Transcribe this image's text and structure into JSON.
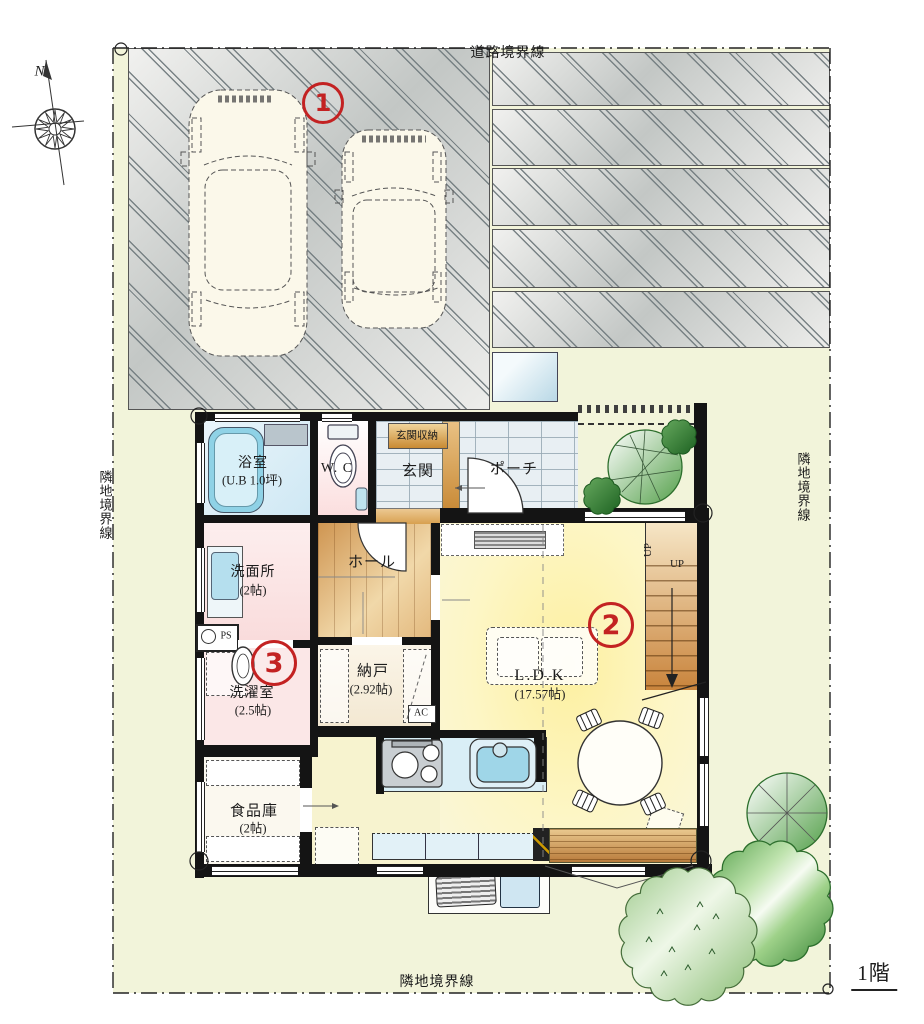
{
  "boundaries": {
    "road": "道路境界線",
    "neighbor_left": "隣地境界線",
    "neighbor_right": "隣地境界線",
    "neighbor_bottom": "隣地境界線"
  },
  "floor_label": "1階",
  "compass": {
    "north": "N"
  },
  "markers": {
    "parking": "1",
    "ldk": "2",
    "laundry": "3"
  },
  "rooms": {
    "bath": {
      "name": "浴室",
      "size": "(U.B 1.0坪)"
    },
    "wc": {
      "name": "W. C"
    },
    "entrance_storage": {
      "name": "玄関収納"
    },
    "entrance": {
      "name": "玄関"
    },
    "porch": {
      "name": "ポーチ"
    },
    "hall": {
      "name": "ホール"
    },
    "washroom": {
      "name": "洗面所",
      "size": "(2帖)"
    },
    "laundry": {
      "name": "洗濯室",
      "size": "(2.5帖)"
    },
    "closet": {
      "name": "納戸",
      "size": "(2.92帖)"
    },
    "pantry": {
      "name": "食品庫",
      "size": "(2帖)"
    },
    "ldk": {
      "name": "L.D.K",
      "size": "(17.57帖)"
    }
  },
  "annotations": {
    "ps": "PS",
    "ac": "AC",
    "up_lower": "UP",
    "up_upper": "UP"
  },
  "colors": {
    "marker_red": "#c32222",
    "site_green": "#f2f4da",
    "ldk_yellow": "#fdf0a0",
    "wood": "#cf9551",
    "pink_room": "#fbe2e4",
    "bath_blue": "#cfe8f4",
    "tree_green": "#3c9140"
  }
}
